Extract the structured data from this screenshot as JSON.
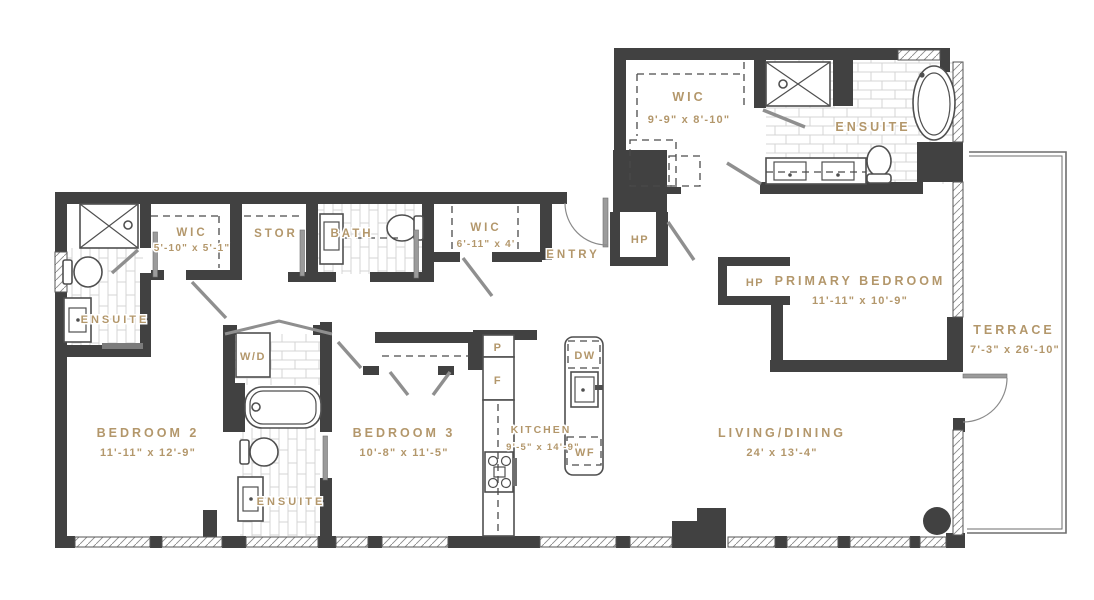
{
  "plan_title": "3 Bedroom + Terrace Floor Plan",
  "colors": {
    "wall": "#414141",
    "label": "#b3976b",
    "fixture": "#4f4f4f",
    "tile": "#d4d4d4"
  },
  "rooms": {
    "wic_primary": {
      "label": "WIC",
      "dims": "9'-9\" x 8'-10\""
    },
    "ensuite_primary": {
      "label": "ENSUITE"
    },
    "wic_hall": {
      "label": "WIC",
      "dims": "5'-10\" x 5'-1\""
    },
    "storage": {
      "label": "STOR"
    },
    "bath": {
      "label": "BATH"
    },
    "wic_entry": {
      "label": "WIC",
      "dims": "6'-11\" x 4'"
    },
    "entry": {
      "label": "ENTRY"
    },
    "hp_entry": {
      "label": "HP"
    },
    "hp_bedroom": {
      "label": "HP"
    },
    "primary_bedroom": {
      "label": "PRIMARY BEDROOM",
      "dims": "11'-11\" x 10'-9\""
    },
    "terrace": {
      "label": "TERRACE",
      "dims": "7'-3\" x 26'-10\""
    },
    "ensuite_bedroom2": {
      "label": "ENSUITE"
    },
    "bedroom2": {
      "label": "BEDROOM 2",
      "dims": "11'-11\" x 12'-9\""
    },
    "laundry": {
      "label": "W/D"
    },
    "ensuite_bedroom3": {
      "label": "ENSUITE"
    },
    "bedroom3": {
      "label": "BEDROOM 3",
      "dims": "10'-8\" x 11'-5\""
    },
    "kitchen": {
      "label": "KITCHEN",
      "dims": "9'-5\" x 14'-9\""
    },
    "living_dining": {
      "label": "LIVING/DINING",
      "dims": "24' x 13'-4\""
    }
  },
  "appliances": {
    "pantry": "P",
    "fridge": "F",
    "dishwasher": "DW",
    "wine_fridge": "WF"
  }
}
